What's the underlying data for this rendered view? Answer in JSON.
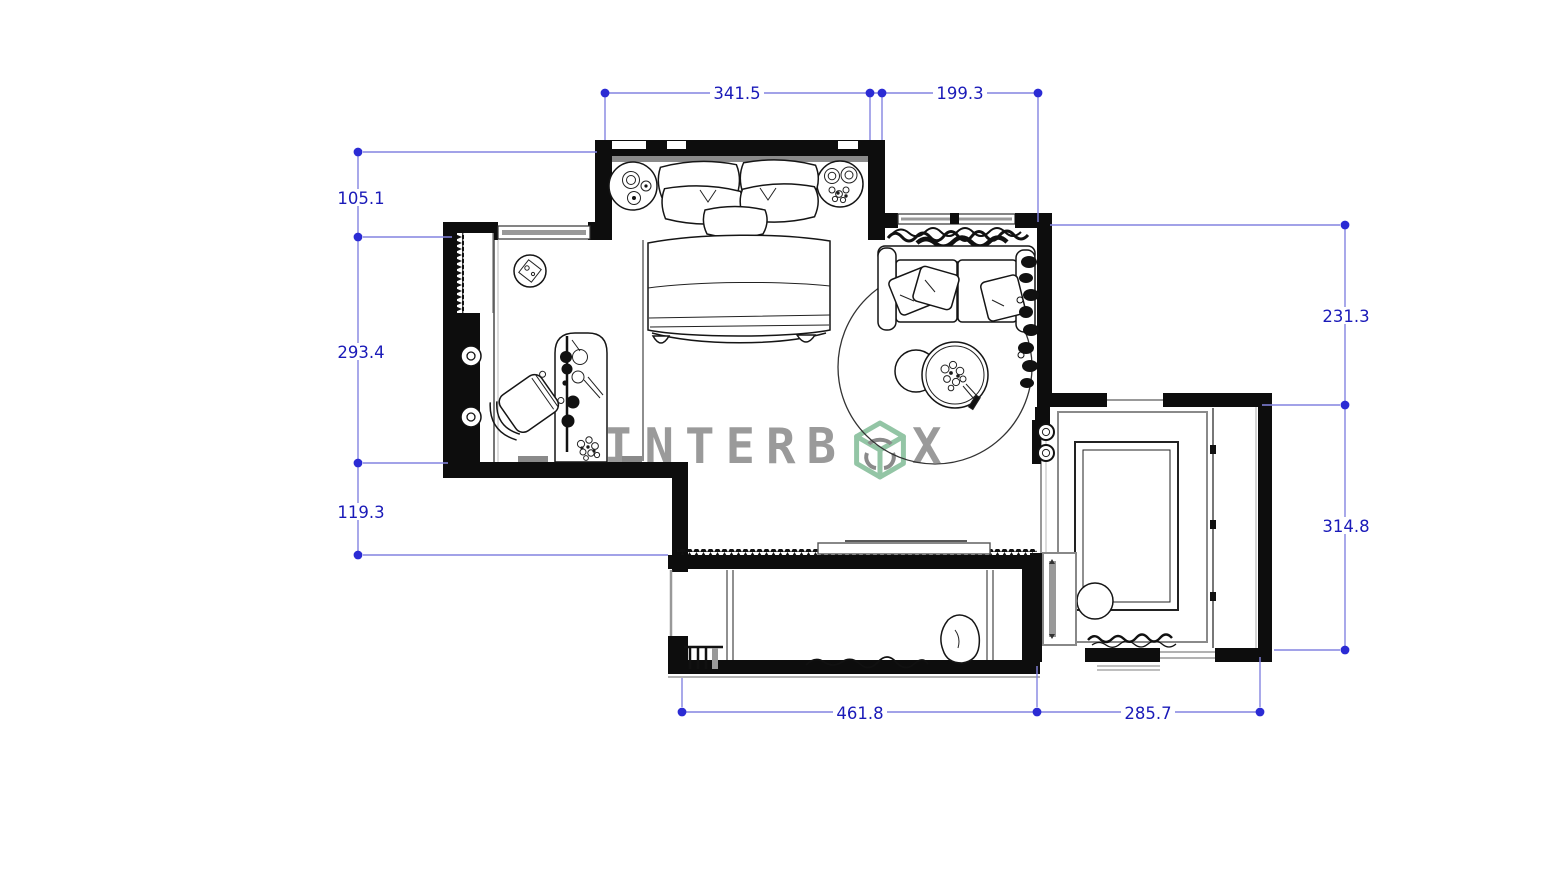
{
  "brand": {
    "name": "INTERBOX",
    "text_left": "INTERB",
    "text_right": "X",
    "cube_icon": "interbox-cube-logo-icon",
    "letter_color": "#9a9a9a",
    "cube_green": "#93c5a5",
    "cube_arc_gray": "#8a8a8a"
  },
  "dimensions": {
    "line_color": "#8484e0",
    "marker_color": "#2b2bd4",
    "text_color": "#1a1ab8",
    "top": [
      {
        "label": "341.5"
      },
      {
        "label": "199.3"
      }
    ],
    "left": [
      {
        "label": "105.1"
      },
      {
        "label": "293.4"
      },
      {
        "label": "119.3"
      }
    ],
    "right": [
      {
        "label": "231.3"
      },
      {
        "label": "314.8"
      }
    ],
    "bottom": [
      {
        "label": "461.8"
      },
      {
        "label": "285.7"
      }
    ]
  },
  "drawing": {
    "ink_color": "#111111",
    "wall_color": "#0d0d0d",
    "muted_color": "#8a8a8a",
    "furniture_icons": [
      "double-bed",
      "bed-pillows",
      "nightstand-lamp",
      "nightstand-plant",
      "recessed-ceiling-light",
      "wardrobe-front",
      "desk",
      "desk-chair",
      "potted-plant",
      "sofa",
      "curtain",
      "sofa-cushions",
      "round-rug",
      "coffee-tables",
      "table-plant",
      "wall-plants",
      "water-taps",
      "shower-enclosure",
      "storage-cabinet",
      "sliding-door-track",
      "towel",
      "balcony-daybed",
      "floor-cushion",
      "bedding",
      "side-stool",
      "sliding-window-panel",
      "window"
    ]
  }
}
